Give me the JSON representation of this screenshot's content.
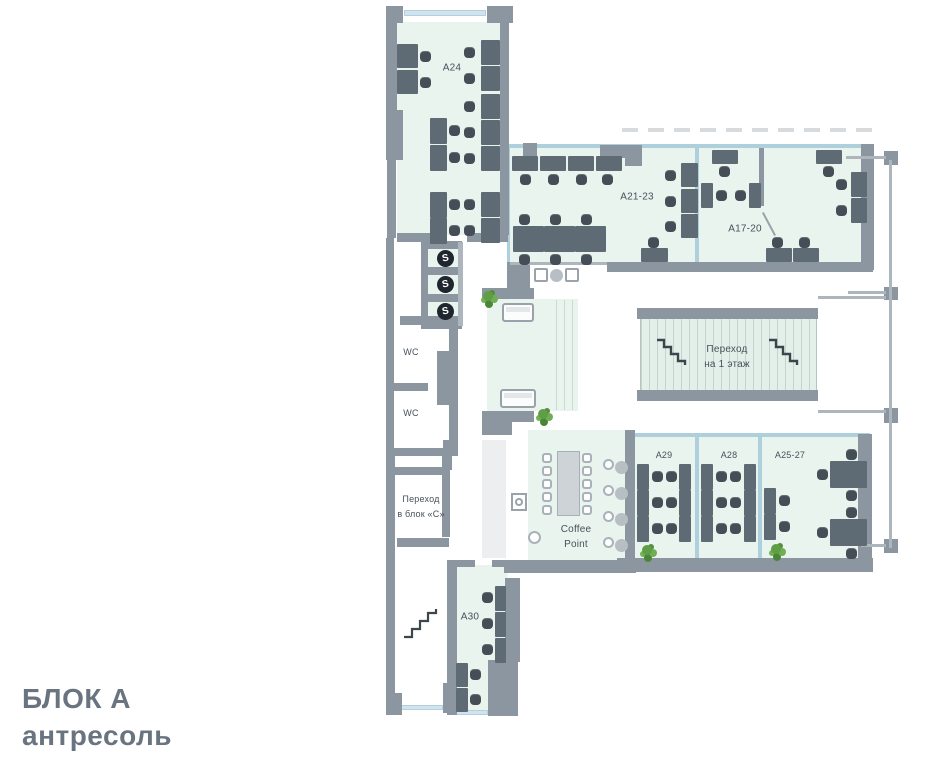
{
  "title": {
    "line1": "БЛОК А",
    "line2": "антресоль"
  },
  "rooms": {
    "a24": {
      "label": "A24"
    },
    "a21_23": {
      "label": "A21-23"
    },
    "a17_20": {
      "label": "A17-20"
    },
    "a29": {
      "label": "A29"
    },
    "a28": {
      "label": "A28"
    },
    "a25_27": {
      "label": "A25-27"
    },
    "a30": {
      "label": "A30"
    },
    "wc_upper": {
      "label": "WC"
    },
    "wc_lower": {
      "label": "WC"
    },
    "coffee_point": {
      "line1": "Coffee",
      "line2": "Point"
    },
    "bridge_stairs": {
      "line1": "Переход",
      "line2": "на 1 этаж"
    },
    "passage_block_c": {
      "line1": "Переход",
      "line2": "в блок «С»"
    }
  },
  "icons": {
    "elevator_label": "S"
  },
  "colors": {
    "wall": "#8c96a0",
    "room_fill": "#e9f4ee",
    "glass_partition": "#aed0dd",
    "window": "#cfe4ee",
    "desk": "#5f6b74",
    "chair": "#454e56",
    "plant": "#5f9e45",
    "bridge_floor": "#e3f0e9",
    "title_text": "#6a7480",
    "label_text": "#47505a"
  }
}
